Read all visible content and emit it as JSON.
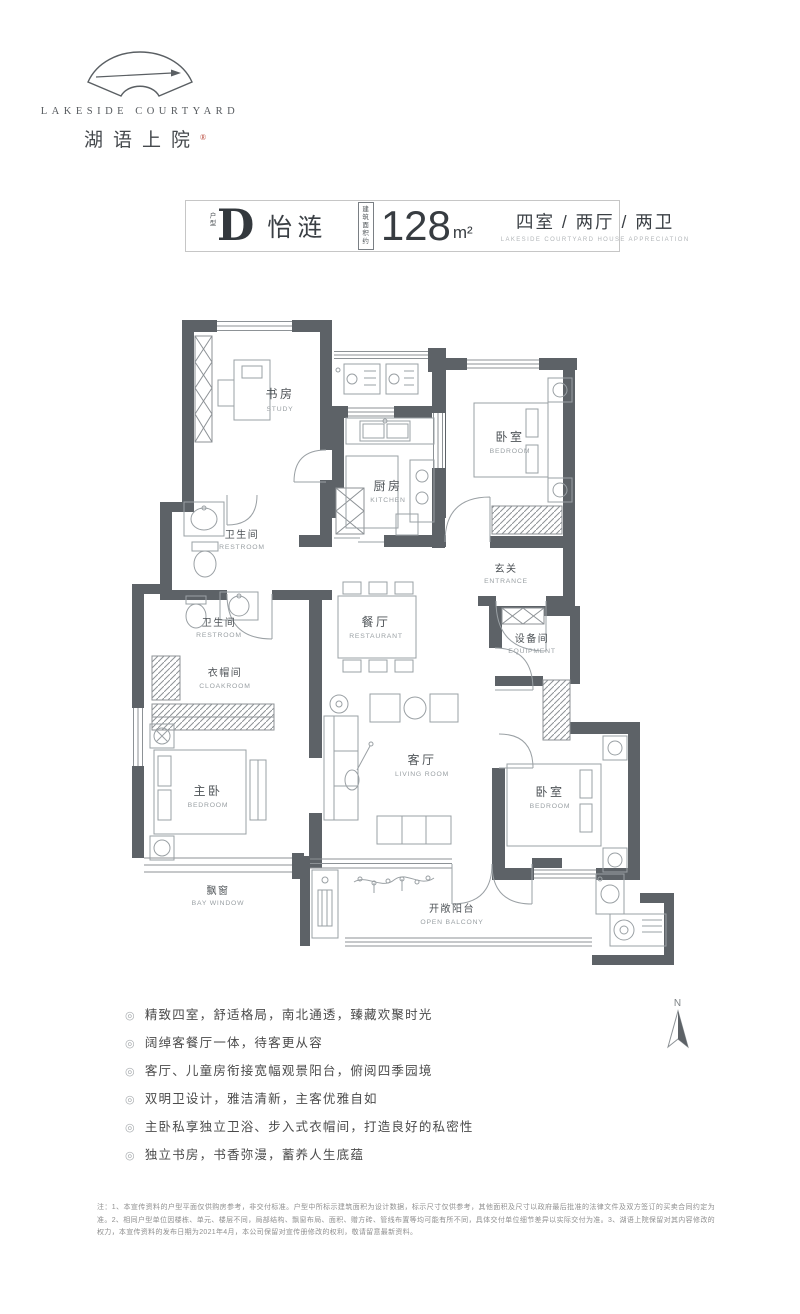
{
  "logo": {
    "brand_en": "LAKESIDE COURTYARD",
    "brand_zh": "湖语上院",
    "trademark": "®"
  },
  "header": {
    "type_tag": "户型",
    "type_letter": "D",
    "type_name": "怡涟",
    "area_label_line1": "建筑",
    "area_label_line2": "面积约",
    "area_value": "128",
    "area_unit": "m²",
    "layout_text": "四室 / 两厅 / 两卫",
    "layout_subtext": "LAKESIDE COURTYARD HOUSE APPRECIATION"
  },
  "floorplan": {
    "compass_label": "N",
    "rooms": {
      "study": {
        "zh": "书房",
        "en": "STUDY"
      },
      "kitchen": {
        "zh": "厨房",
        "en": "KITCHEN"
      },
      "bedroom_top_right": {
        "zh": "卧室",
        "en": "BEDROOM"
      },
      "entrance": {
        "zh": "玄关",
        "en": "ENTRANCE"
      },
      "restroom_upper": {
        "zh": "卫生间",
        "en": "RESTROOM"
      },
      "restroom_lower": {
        "zh": "卫生间",
        "en": "RESTROOM"
      },
      "cloakroom": {
        "zh": "衣帽间",
        "en": "CLOAKROOM"
      },
      "dining": {
        "zh": "餐厅",
        "en": "RESTAURANT"
      },
      "equipment": {
        "zh": "设备间",
        "en": "EQUIPMENT"
      },
      "master_bedroom": {
        "zh": "主卧",
        "en": "BEDROOM"
      },
      "living": {
        "zh": "客厅",
        "en": "LIVING ROOM"
      },
      "bedroom_bottom_right": {
        "zh": "卧室",
        "en": "BEDROOM"
      },
      "bay_window": {
        "zh": "飘窗",
        "en": "BAY WINDOW"
      },
      "balcony": {
        "zh": "开敞阳台",
        "en": "OPEN BALCONY"
      }
    }
  },
  "features": {
    "marker": "◎",
    "items": [
      "精致四室，舒适格局，南北通透，臻藏欢聚时光",
      "阔绰客餐厅一体，待客更从容",
      "客厅、儿童房衔接宽幅观景阳台，俯阅四季园境",
      "双明卫设计，雅洁清新，主客优雅自如",
      "主卧私享独立卫浴、步入式衣帽间，打造良好的私密性",
      "独立书房，书香弥漫，蓄养人生底蕴"
    ]
  },
  "disclaimer": "注：1、本宣传资料的户型平面仅供购房参考，非交付标准。户型中所标示建筑面积为设计数据，标示尺寸仅供参考，其他面积及尺寸以政府最后批准的法律文件及双方签订的买卖合同约定为准。2、相同户型单位因楼栋、单元、楼层不同，局部结构、飘窗布局、面积、赠方砖、管线布置等均可能有所不同，具体交付单位细节差异以实际交付为准。3、湖语上院保留对其内容修改的权力，本宣传资料的发布日期为2021年4月，本公司保留对宣传册修改的权利，敬请留意最新资料。",
  "colors": {
    "wall": "#5d6267",
    "line": "#9aa0a4",
    "accent_red": "#b43c2e"
  }
}
